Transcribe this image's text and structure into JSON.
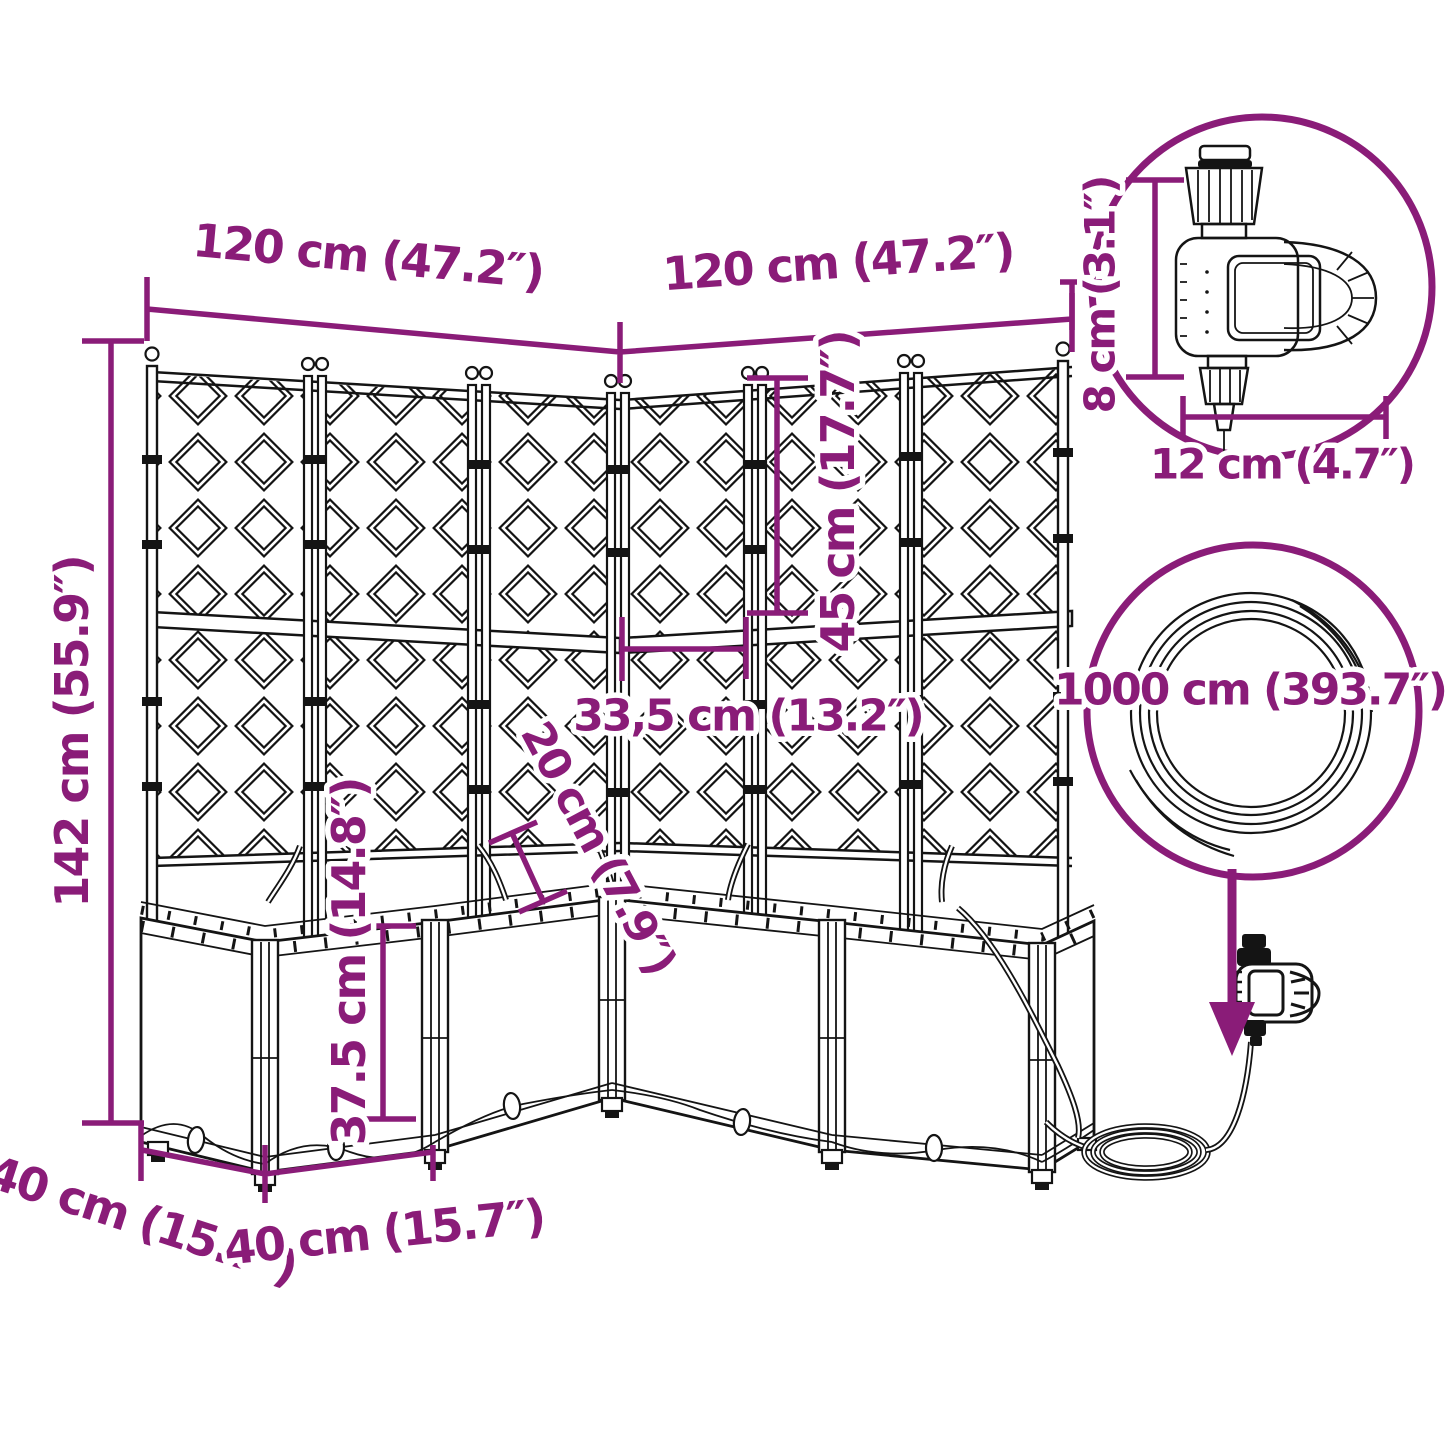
{
  "diagram": {
    "accent_color": "#8A1C78",
    "line_color": "#141414",
    "labels": {
      "top_left_width": "120 cm (47.2″)",
      "top_right_width": "120 cm (47.2″)",
      "total_height": "142 cm (55.9″)",
      "trellis_section_height": "45 cm (17.7″)",
      "inner_spacing": "33,5 cm (13.2″)",
      "inner_depth": "20 cm (7.9″)",
      "planter_height": "37.5 cm (14.8″)",
      "side_depth": "40 cm (15.7″)",
      "front_width": "40 cm (15.7″)",
      "timer_height": "8 cm (3.1″)",
      "timer_width": "12 cm (4.7″)",
      "hose_length": "1000 cm (393.7″)"
    }
  }
}
